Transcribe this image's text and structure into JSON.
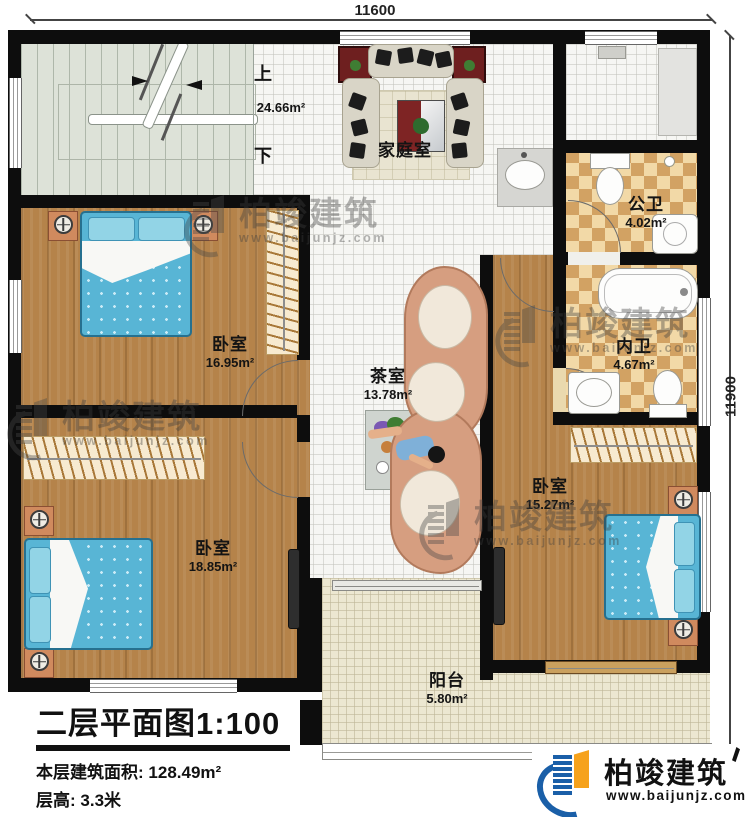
{
  "dimensions": {
    "top": "11600",
    "right": "11900"
  },
  "stairs": {
    "up": "上",
    "down": "下"
  },
  "rooms": {
    "family": {
      "name": "家庭室",
      "area": "24.66m²"
    },
    "public_bath": {
      "name": "公卫",
      "area": "4.02m²"
    },
    "inner_bath": {
      "name": "内卫",
      "area": "4.67m²"
    },
    "bedroom_nw": {
      "name": "卧室",
      "area": "16.95m²"
    },
    "tea_room": {
      "name": "茶室",
      "area": "13.78m²"
    },
    "bedroom_sw": {
      "name": "卧室",
      "area": "18.85m²"
    },
    "bedroom_se": {
      "name": "卧室",
      "area": "15.27m²"
    },
    "balcony": {
      "name": "阳台",
      "area": "5.80m²"
    }
  },
  "title_block": {
    "title": "二层平面图",
    "scale": "1:100",
    "area_label": "本层建筑面积:",
    "area_value": "128.49m²",
    "height_label": "层高:",
    "height_value": "3.3米"
  },
  "branding": {
    "name": "柏竣建筑",
    "website": "www.baijunjz.com"
  },
  "watermark": {
    "name": "柏竣建筑",
    "website": "www.baijunjz.com"
  },
  "colors": {
    "wall": "#0d0d0d",
    "wood": "#b5834a",
    "tile": "#f6f6f3",
    "checker_light": "#f2d9a7",
    "checker_dark": "#d2a263",
    "stairs": "#dde2d8",
    "balcony": "#ece7d1",
    "bed": "#58b5d5",
    "logo_blue": "#1a5fa8",
    "logo_orange": "#f6a21c"
  }
}
